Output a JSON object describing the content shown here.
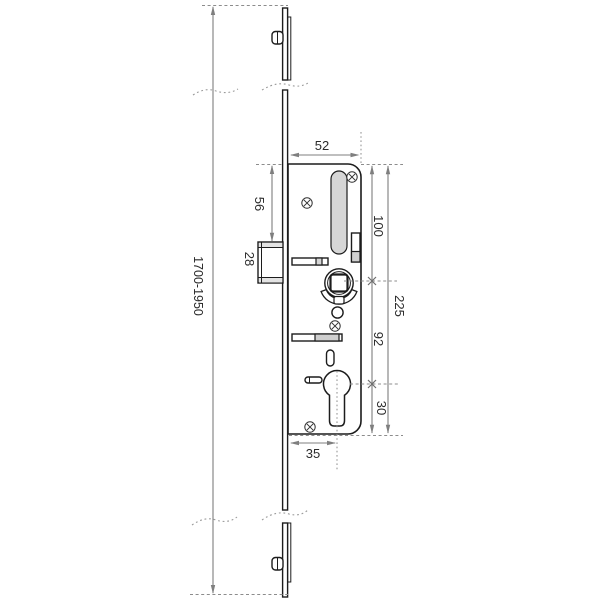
{
  "drawing": {
    "dimensions": {
      "overall_height": "1700-1950",
      "case_depth": "52",
      "faceplate_to_latch": "56",
      "latch_height": "28",
      "top_to_follower": "100",
      "case_length": "225",
      "follower_to_cylinder": "92",
      "cylinder_to_bottom": "30",
      "backset": "35"
    }
  }
}
